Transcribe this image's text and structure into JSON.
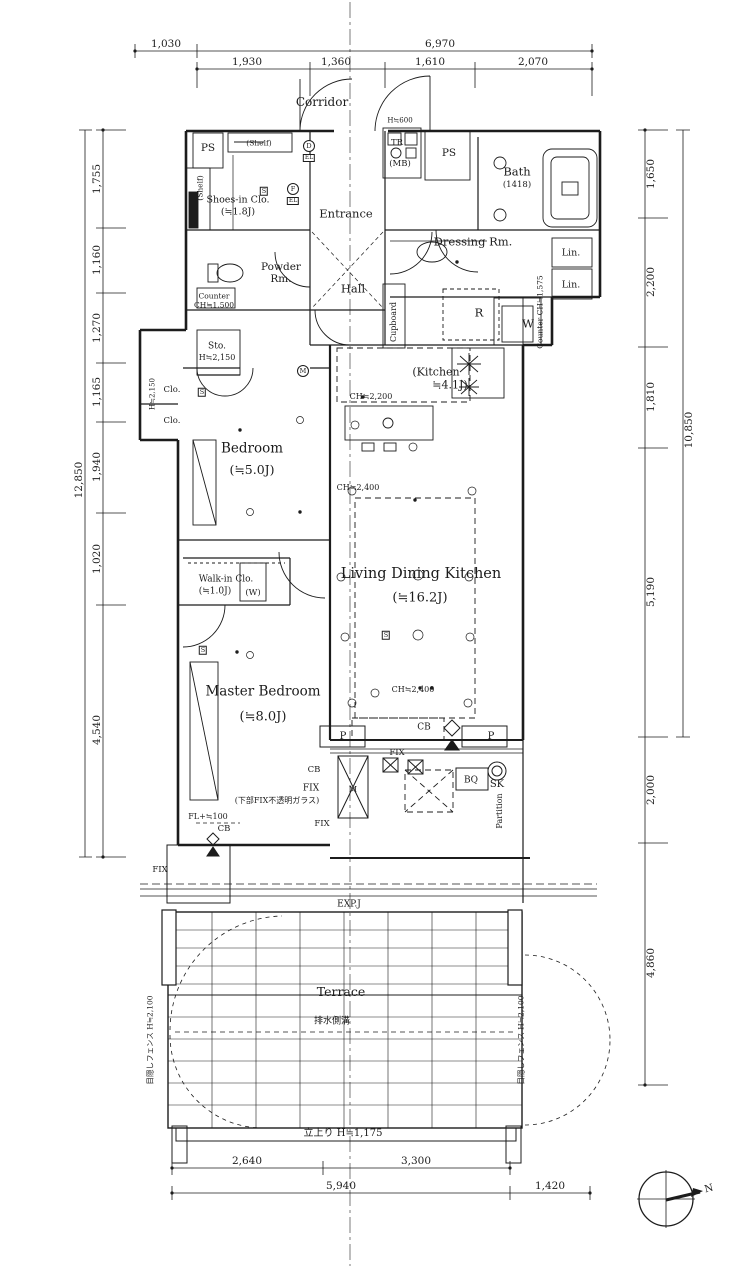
{
  "colors": {
    "line": "#1c1c1c",
    "background": "#ffffff"
  },
  "compass": {
    "north": "N"
  },
  "dim_labels": {
    "d1030": "1,030",
    "d6970": "6,970",
    "d1930": "1,930",
    "d1360": "1,360",
    "d1610": "1,610",
    "d2070": "2,070",
    "d1755": "1,755",
    "d1160": "1,160",
    "d1270": "1,270",
    "d1165": "1,165",
    "d1940": "1,940",
    "d1020": "1,020",
    "d4540": "4,540",
    "d12850": "12,850",
    "d1650": "1,650",
    "d2200": "2,200",
    "d1810": "1,810",
    "d5190": "5,190",
    "d10850": "10,850",
    "d2000": "2,000",
    "d4860": "4,860",
    "d2640": "2,640",
    "d3300": "3,300",
    "d5940": "5,940",
    "d1420": "1,420",
    "parapet": "立上り H≒1,175"
  },
  "room_labels": {
    "corridor": "Corridor",
    "ps_left": "PS",
    "ps_right": "PS",
    "shelf_top": "(Shelf)",
    "shelf_side": "(Shelf)",
    "shoes": "Shoes-in Clo.",
    "shoes_size": "(≒1.8J)",
    "entrance": "Entrance",
    "hall": "Hall",
    "h600": "H≒600",
    "tr": "TR",
    "mb": "(MB)",
    "bath": "Bath",
    "bath_size": "(1418)",
    "dressing": "Dressing Rm.",
    "lin1": "Lin.",
    "lin2": "Lin.",
    "powder1": "Powder",
    "powder2": "Rm.",
    "counter_l1": "Counter",
    "counter_l2": "CH≒1,500",
    "r": "R",
    "w": "W",
    "counter_r": "Counter CH≒1,575",
    "cupboard": "Cupboard",
    "sto": "Sto.",
    "sto_h": "H≒2,150",
    "kitchen1": "(Kitchen",
    "kitchen2": "≒4.1J)",
    "ch2200": "CH≒2,200",
    "h2150": "H≒2,150",
    "clo1": "Clo.",
    "clo2": "Clo.",
    "bedroom": "Bedroom",
    "bedroom_size": "(≒5.0J)",
    "ldk": "Living Dining Kitchen",
    "ldk_size": "(≒16.2J)",
    "wic": "Walk-in Clo.",
    "wic_size": "(≒1.0J)",
    "w_paren": "(W)",
    "master": "Master Bedroom",
    "master_size": "(≒8.0J)",
    "terrace": "Terrace"
  },
  "annotation_labels": {
    "ch2400a": "CH≒2,400",
    "ch2400b": "CH≒2,400",
    "cb1": "CB",
    "cb2": "CB",
    "cb3": "CB",
    "p1": "P",
    "p2": "P",
    "fix1": "FIX",
    "fix2": "FIX",
    "fix3": "FIX",
    "fix4": "FIX",
    "fix_note": "(下部FIX不透明ガラス)",
    "bq": "BQ",
    "sk": "SK",
    "partition": "Partition",
    "fl100": "FL+≒100",
    "m_box": "M",
    "expj": "EXP.J",
    "drain": "排水側溝",
    "fence_l": "目隠しフェンス H≒2,100",
    "fence_r": "目隠しフェンス H≒2,100"
  },
  "symbol_labels": {
    "sD": "D",
    "sEL1": "EL",
    "sF": "F",
    "sEL2": "EL",
    "sS1": "S",
    "sS2": "S",
    "sS3": "S",
    "sS4": "S",
    "sM": "M"
  }
}
